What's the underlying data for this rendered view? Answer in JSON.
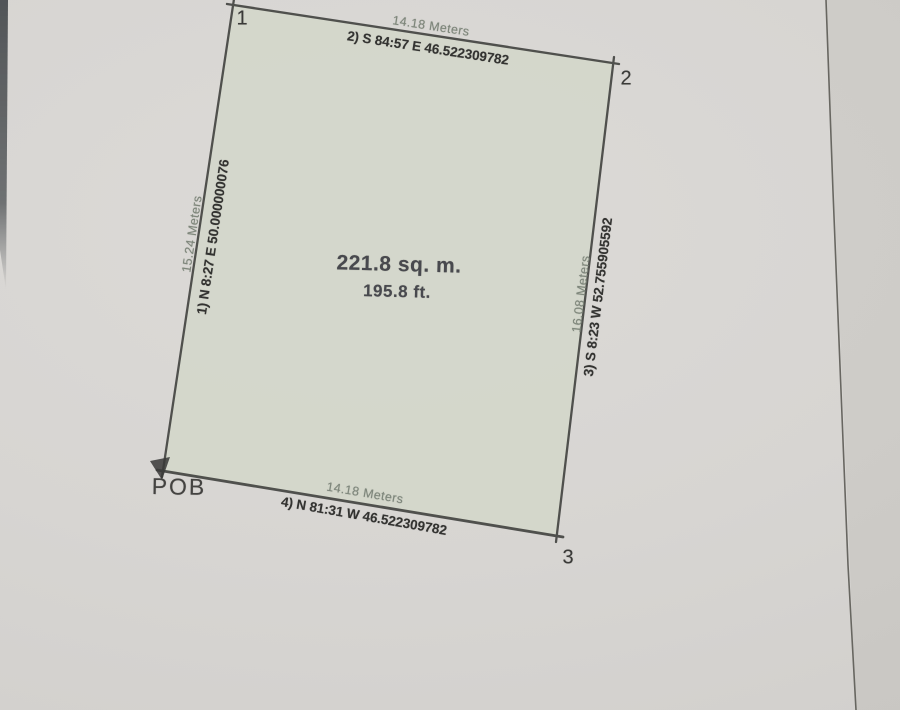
{
  "plan": {
    "title_area_sqm": "221.8 sq. m.",
    "title_area_ft": "195.8 ft.",
    "pob_label": "POB",
    "corner_labels": [
      "1",
      "2",
      "3"
    ],
    "edges": [
      {
        "side": "top",
        "distance": "14.18 Meters",
        "bearing": "2) S 84:57 E 46.522309782"
      },
      {
        "side": "right",
        "distance": "16.08 Meters",
        "bearing": "3) S 8:23 W 52.755905592"
      },
      {
        "side": "bottom",
        "distance": "14.18 Meters",
        "bearing": "4) N 81:31 W 46.522309782"
      },
      {
        "side": "left",
        "distance": "15.24 Meters",
        "bearing": "1) N 8:27 E 50.000000076"
      }
    ],
    "colors": {
      "paper": "#d7d5d2",
      "parcel_fill": "#d3d6ca",
      "survey_line": "#454643",
      "bearing_text": "#343432",
      "distance_text": "#7e867b",
      "label_text": "#3b3b39"
    }
  }
}
